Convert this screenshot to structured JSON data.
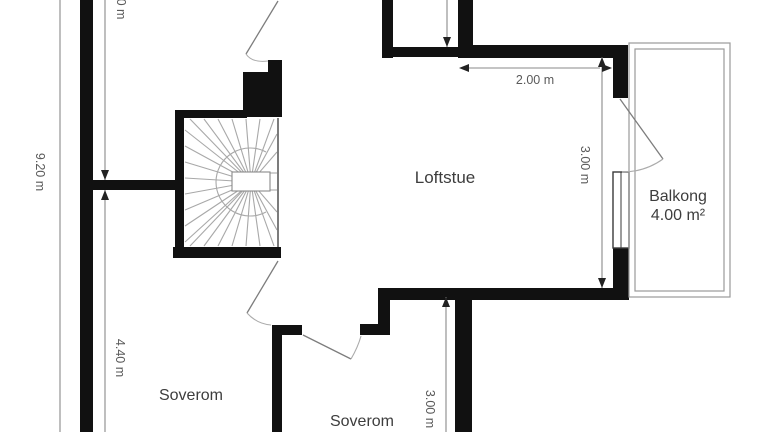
{
  "plan": {
    "title": "Floor plan (loft level)",
    "rooms": [
      {
        "id": "loftstue",
        "label": "Loftstue"
      },
      {
        "id": "balkong",
        "label": "Balkong",
        "area": "4.00 m²"
      },
      {
        "id": "soverom-1",
        "label": "Soverom"
      },
      {
        "id": "soverom-2",
        "label": "Soverom"
      }
    ],
    "dimensions": {
      "outer_height": "9.20 m",
      "upper_left_partial": "0 m",
      "lower_left_height": "4.40 m",
      "loftstue_width": "2.00 m",
      "loftstue_right_height": "3.00 m",
      "soverom2_height": "3.00 m"
    },
    "colors": {
      "background": "#ffffff",
      "wall": "#111111",
      "thin_line": "#8a8a8a",
      "stair_line": "#a8a8a8",
      "room_text": "#3d3d3d",
      "dim_text": "#5a5a5a"
    }
  }
}
